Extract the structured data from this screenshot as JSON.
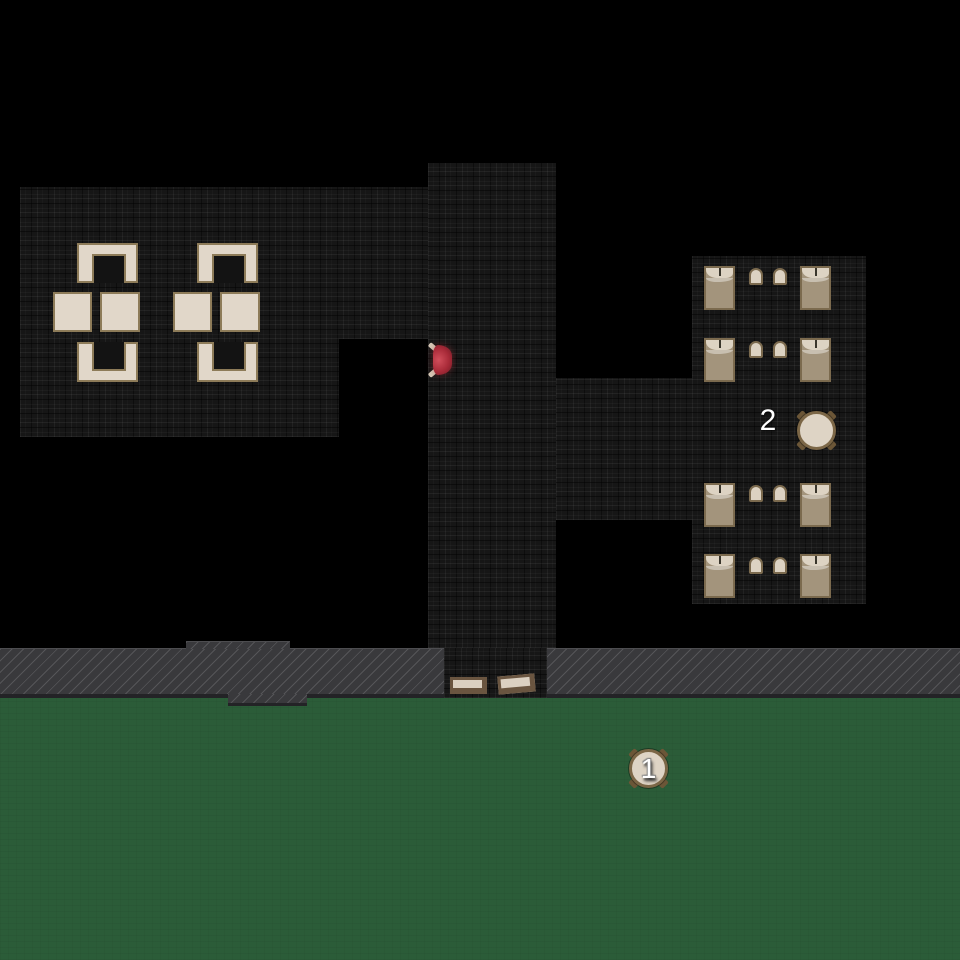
{
  "scene": {
    "type": "top-down-tactical-floorplan",
    "canvas": {
      "width": 960,
      "height": 960
    },
    "background": "#000000"
  },
  "markers": [
    {
      "id": "objective-1",
      "label": "1",
      "x": 629,
      "y": 749,
      "placement": "on round patio table on lawn"
    },
    {
      "id": "objective-2",
      "label": "2",
      "x": 755,
      "y": 405,
      "placement": "beside round table in bedroom"
    }
  ],
  "palette": {
    "void_black": "#000000",
    "floor_dark": "#161616",
    "lawn_green": "#2b5c38",
    "road_gray": "#39393c",
    "road_stripe": "#55555a",
    "furniture_cream": "#e1d7c9",
    "furniture_border_tan": "#8d7b58",
    "bed_blanket": "#a3947c",
    "bed_pillow": "#ddd3c3",
    "round_table_border": "#7c6747",
    "mat_border_brown": "#6a5540",
    "red_chair": "#a82a38",
    "marker_text": "#ffffff"
  },
  "regions": {
    "dining_room_upper": {
      "x": 20,
      "y": 187,
      "w": 408,
      "h": 152
    },
    "dining_room_lower": {
      "x": 20,
      "y": 339,
      "w": 319,
      "h": 98
    },
    "corridor_vertical": {
      "x": 428,
      "y": 163,
      "w": 128,
      "h": 485
    },
    "entrance_hall": {
      "x": 444,
      "y": 648,
      "w": 103,
      "h": 50
    },
    "corridor_horizontal": {
      "x": 556,
      "y": 378,
      "w": 136,
      "h": 142
    },
    "bedroom": {
      "x": 692,
      "y": 256,
      "w": 174,
      "h": 348
    },
    "road": {
      "x": 0,
      "y": 648,
      "w": 960,
      "h": 50
    },
    "road_bump_top": {
      "x": 186,
      "y": 641,
      "w": 104,
      "h": 8
    },
    "road_bump_bottom": {
      "x": 228,
      "y": 694,
      "w": 79,
      "h": 12
    },
    "lawn": {
      "x": 0,
      "y": 698,
      "w": 960,
      "h": 262
    }
  },
  "furniture": {
    "beds": [
      {
        "x": 704,
        "y": 266
      },
      {
        "x": 800,
        "y": 266
      },
      {
        "x": 704,
        "y": 338
      },
      {
        "x": 800,
        "y": 338
      },
      {
        "x": 704,
        "y": 483
      },
      {
        "x": 800,
        "y": 483
      },
      {
        "x": 704,
        "y": 554
      },
      {
        "x": 800,
        "y": 554
      }
    ],
    "nightstands": [
      {
        "x": 749,
        "y": 268
      },
      {
        "x": 773,
        "y": 268
      },
      {
        "x": 749,
        "y": 341
      },
      {
        "x": 773,
        "y": 341
      },
      {
        "x": 749,
        "y": 485
      },
      {
        "x": 773,
        "y": 485
      },
      {
        "x": 749,
        "y": 557
      },
      {
        "x": 773,
        "y": 557
      }
    ],
    "dining_tables": [
      {
        "x": 53,
        "y": 292,
        "w": 39,
        "h": 40
      },
      {
        "x": 100,
        "y": 292,
        "w": 40,
        "h": 40
      },
      {
        "x": 173,
        "y": 292,
        "w": 39,
        "h": 40
      },
      {
        "x": 220,
        "y": 292,
        "w": 40,
        "h": 40
      }
    ],
    "dining_benches": [
      {
        "x": 77,
        "y": 243,
        "opening": "down"
      },
      {
        "x": 77,
        "y": 342,
        "opening": "up"
      },
      {
        "x": 197,
        "y": 243,
        "opening": "down"
      },
      {
        "x": 197,
        "y": 342,
        "opening": "up"
      }
    ],
    "round_tables": [
      {
        "x": 797,
        "y": 411,
        "marker": null
      },
      {
        "x": 629,
        "y": 749,
        "marker": "markers.0.label"
      }
    ],
    "door_mats": [
      {
        "x": 450,
        "y": 677,
        "w": 37,
        "h": 17,
        "rotate": 0
      },
      {
        "x": 498,
        "y": 675,
        "w": 37,
        "h": 18,
        "rotate": -5
      }
    ],
    "red_chair": {
      "x": 428,
      "y": 341
    }
  }
}
